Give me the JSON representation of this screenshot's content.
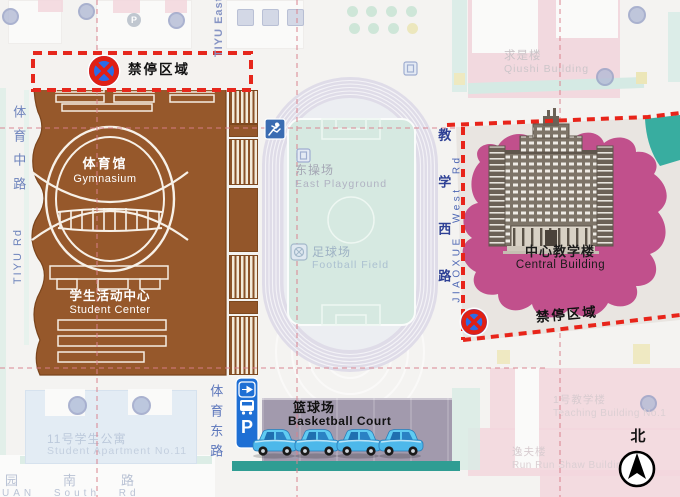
{
  "zones": {
    "no_parking_top": "禁停区域",
    "no_parking_right": "禁停区域"
  },
  "places": {
    "gymnasium_zh": "体育馆",
    "gymnasium_en": "Gymnasium",
    "student_center_zh": "学生活动中心",
    "student_center_en": "Student Center",
    "east_playground_zh": "东操场",
    "east_playground_en": "East Playground",
    "football_field_zh": "足球场",
    "football_field_en": "Football Field",
    "central_building_zh": "中心教学楼",
    "central_building_en": "Central Building",
    "basketball_court_zh": "篮球场",
    "basketball_court_en": "Basketball Court",
    "student_apartment_zh": "11号学生公寓",
    "student_apartment_en": "Student Apartment No.11",
    "qiushi_zh": "求是楼",
    "qiushi_en": "Qiushi Building",
    "teaching1_zh": "1号教学楼",
    "teaching1_en": "Teaching Building No.1",
    "shaw_zh": "逸夫楼",
    "shaw_en": "Run Run Shaw Building"
  },
  "roads": {
    "tiyu_middle_zh": "体育中路",
    "tiyu_middle_en": "TIYU Rd",
    "tiyu_east_top_en": "TIYU East",
    "tiyu_east_zh": "体育东路",
    "jiaoxue_west_zh": "教学西路",
    "jiaoxue_west_en": "JIAOXUE West Rd",
    "south_zh": "园南路",
    "south_en": "UAN South Rd"
  },
  "compass": {
    "north_label": "北"
  },
  "parking": {
    "p_label": "P"
  },
  "background": {
    "p_badge": "P"
  },
  "colors": {
    "gym_brown": "#96582b",
    "blob_pink": "#c1508c",
    "no_parking_red": "#e6271c",
    "field_teal": "#d6e9e1",
    "track_lavender": "#dfdce8",
    "court_purple": "#a29aad",
    "teal_strip": "#2f9d93",
    "car_blue": "#5fcbf2",
    "sign_blue": "#1f6fd6"
  }
}
